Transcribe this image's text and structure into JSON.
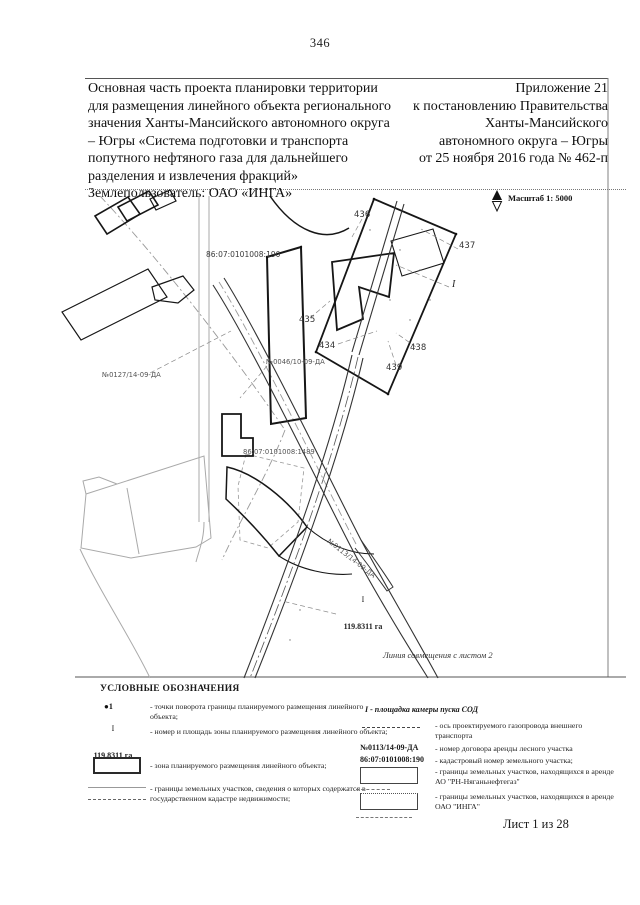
{
  "page": {
    "number": "346",
    "sheet": "Лист 1 из 28"
  },
  "header": {
    "left": "Основная часть проекта планировки территории\nдля размещения линейного объекта регионального\nзначения Ханты-Мансийского автономного округа\n– Югры «Система подготовки и транспорта\nпопутного нефтяного газа для дальнейшего\nразделения и извлечения фракций»\nЗемлепользователь: ОАО «ИНГА»",
    "right": "Приложение 21\nк постановлению Правительства\nХанты-Мансийского\nавтономного округа – Югры\nот 25 ноября 2016 года № 462-п"
  },
  "map": {
    "scale_label": "Масштаб 1: 5000",
    "labels": {
      "cad190": "86:07:0101008:190",
      "cad1489": "86:07:0101008:1489",
      "lease0127": "№0127/14-09-ДА",
      "lease0046": "№0046/10-09-ДА",
      "lease0113": "№0113/14-09-ДА",
      "p434": "434",
      "p435": "435",
      "p436": "436",
      "p437": "437",
      "p438": "438",
      "p439": "439",
      "zone_number": "I",
      "zone_area": "119.8311 га",
      "match_line": "Линия совмещения с листом 2"
    }
  },
  "legend": {
    "title": "УСЛОВНЫЕ ОБОЗНАЧЕНИЯ",
    "left": [
      {
        "symbol_text": "●1",
        "label": "- точки поворота границы планируемого размещения линейного объекта;"
      },
      {
        "num": "I",
        "den": "119.8311 га",
        "label": "- номер и площадь зоны планируемого размещения линейного объекта;"
      },
      {
        "label": "- зона планируемого размещения линейного объекта;"
      },
      {
        "label": "- границы земельных участков, сведения о которых содержатся в государственном кадастре недвижимости;"
      }
    ],
    "right": [
      {
        "heading": "I - площадка камеры пуска СОД"
      },
      {
        "label": "- ось проектируемого газопровода внешнего транспорта"
      },
      {
        "symbol_text": "№0113/14-09-ДА",
        "label": "- номер договора аренды лесного участка"
      },
      {
        "symbol_text": "86:07:0101008:190",
        "label": "- кадастровый номер земельного участка;"
      },
      {
        "label": "- границы земельных участков, находящихся в аренде АО \"РН-Няганьнефтегаз\""
      },
      {
        "label": "- границы земельных участков, находящихся в аренде ОАО \"ИНГА\""
      }
    ]
  }
}
